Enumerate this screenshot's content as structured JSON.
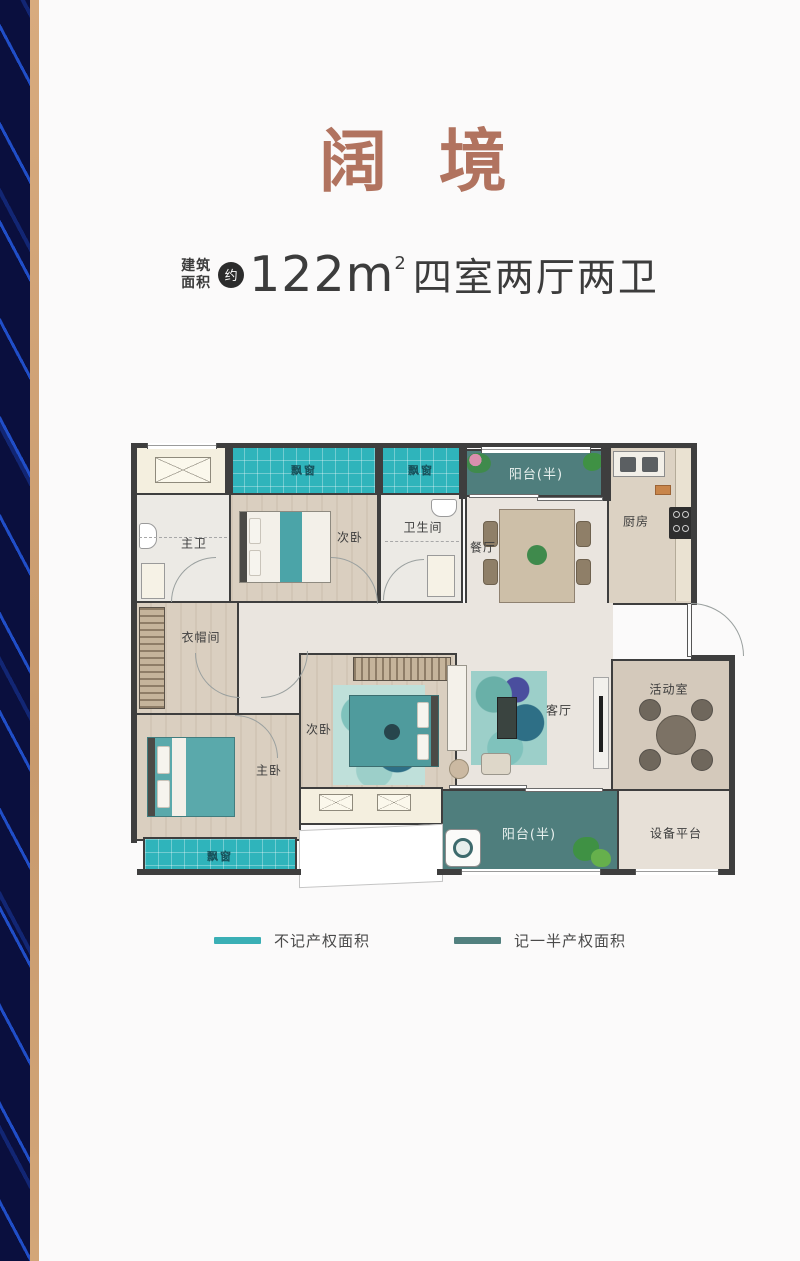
{
  "header": {
    "title": "阔 境"
  },
  "spec": {
    "area_label_top": "建筑",
    "area_label_bottom": "面积",
    "badge": "约",
    "area_number": "122",
    "area_unit": "m",
    "area_sup": "2",
    "layout_text": "四室两厅两卫"
  },
  "floorplan": {
    "bay_windows": [
      {
        "label": "飘窗"
      },
      {
        "label": "飘窗"
      },
      {
        "label": "飘窗"
      }
    ],
    "balconies": [
      {
        "label": "阳台(半)"
      },
      {
        "label": "阳台(半)"
      }
    ],
    "rooms": [
      {
        "id": "master-bath",
        "label": "主卫"
      },
      {
        "id": "bedroom-top",
        "label": "次卧"
      },
      {
        "id": "bathroom",
        "label": "卫生间"
      },
      {
        "id": "dining-room",
        "label": "餐厅"
      },
      {
        "id": "kitchen",
        "label": "厨房"
      },
      {
        "id": "cloakroom",
        "label": "衣帽间"
      },
      {
        "id": "bedroom-mid",
        "label": "次卧"
      },
      {
        "id": "living-room",
        "label": "客厅"
      },
      {
        "id": "activity-room",
        "label": "活动室"
      },
      {
        "id": "master-bedroom",
        "label": "主卧"
      },
      {
        "id": "equipment-platform",
        "label": "设备平台"
      }
    ]
  },
  "legend": {
    "items": [
      {
        "label": "不记产权面积",
        "color": "#3aafb5"
      },
      {
        "label": "记一半产权面积",
        "color": "#52807f"
      }
    ]
  },
  "colors": {
    "title": "#b1735f",
    "bay_window_teal": "#2fb4bb",
    "balcony_teal": "#4f7e7d",
    "wall": "#3e3e3e",
    "sidebar_navy": "#0a0f3e",
    "sidebar_tan": "#cc9f72"
  }
}
